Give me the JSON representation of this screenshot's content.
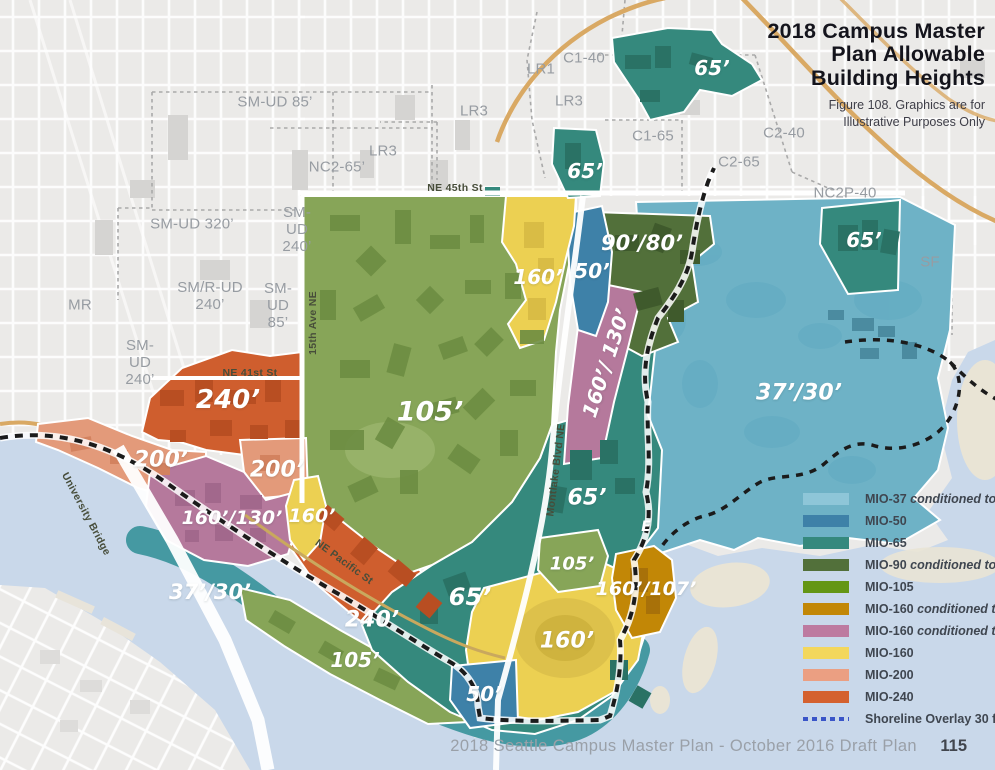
{
  "title": {
    "lines": [
      "2018 Campus Master",
      "Plan Allowable",
      "Building Heights"
    ],
    "subtitle_lines": [
      "Figure 108. Graphics are for",
      "Illustrative Purposes Only"
    ]
  },
  "footer": {
    "caption": "2018 Seattle Campus Master Plan - October 2016 Draft Plan",
    "page": "115"
  },
  "legend": {
    "items": [
      {
        "label": "MIO-37",
        "condition": "conditioned to 30",
        "color": "#8ec6d8"
      },
      {
        "label": "MIO-50",
        "condition": "",
        "color": "#3e81a8"
      },
      {
        "label": "MIO-65",
        "condition": "",
        "color": "#35897d"
      },
      {
        "label": "MIO-90",
        "condition": "conditioned to 80",
        "color": "#52703a"
      },
      {
        "label": "MIO-105",
        "condition": "",
        "color": "#649614"
      },
      {
        "label": "MIO-160",
        "condition": "conditioned to 107",
        "color": "#c28706"
      },
      {
        "label": "MIO-160",
        "condition": "conditioned to 130",
        "color": "#bd7aa0"
      },
      {
        "label": "MIO-160",
        "condition": "",
        "color": "#f3d75c"
      },
      {
        "label": "MIO-200",
        "condition": "",
        "color": "#eb9f82"
      },
      {
        "label": "MIO-240",
        "condition": "",
        "color": "#d4612f"
      }
    ],
    "shoreline": {
      "label": "Shoreline Overlay 30 ft",
      "color": "#3a55c8"
    }
  },
  "map": {
    "height_labels": [
      {
        "text": "65’",
        "x": 712,
        "y": 68,
        "size": 20
      },
      {
        "text": "65’",
        "x": 585,
        "y": 171,
        "size": 20
      },
      {
        "text": "90’/80’",
        "x": 642,
        "y": 243,
        "size": 21
      },
      {
        "text": "160’",
        "x": 538,
        "y": 277,
        "size": 20
      },
      {
        "text": "50’",
        "x": 592,
        "y": 271,
        "size": 20
      },
      {
        "text": "65’",
        "x": 864,
        "y": 240,
        "size": 20
      },
      {
        "text": "160’/ 130’",
        "x": 606,
        "y": 363,
        "size": 20,
        "rotate": -72
      },
      {
        "text": "37’/30’",
        "x": 799,
        "y": 393,
        "size": 22
      },
      {
        "text": "105’",
        "x": 430,
        "y": 412,
        "size": 27
      },
      {
        "text": "240’",
        "x": 228,
        "y": 400,
        "size": 26
      },
      {
        "text": "200’",
        "x": 161,
        "y": 460,
        "size": 22
      },
      {
        "text": "200’",
        "x": 277,
        "y": 470,
        "size": 22
      },
      {
        "text": "160’/130’",
        "x": 232,
        "y": 518,
        "size": 19
      },
      {
        "text": "160’",
        "x": 312,
        "y": 516,
        "size": 19
      },
      {
        "text": "37’/30’",
        "x": 210,
        "y": 592,
        "size": 21
      },
      {
        "text": "65’",
        "x": 470,
        "y": 597,
        "size": 24
      },
      {
        "text": "240’",
        "x": 372,
        "y": 620,
        "size": 22
      },
      {
        "text": "105’",
        "x": 355,
        "y": 660,
        "size": 20
      },
      {
        "text": "65’",
        "x": 587,
        "y": 498,
        "size": 22
      },
      {
        "text": "105’",
        "x": 572,
        "y": 564,
        "size": 18
      },
      {
        "text": "160’/107’",
        "x": 646,
        "y": 589,
        "size": 19
      },
      {
        "text": "160’",
        "x": 567,
        "y": 641,
        "size": 22
      },
      {
        "text": "50’",
        "x": 484,
        "y": 694,
        "size": 20
      },
      {
        "text": "E",
        "x": 646,
        "y": 527,
        "size": 14
      }
    ],
    "zoning_labels": [
      {
        "text": "SM-UD 85’",
        "x": 275,
        "y": 103
      },
      {
        "text": "LR3",
        "x": 383,
        "y": 152
      },
      {
        "text": "LR3",
        "x": 474,
        "y": 112
      },
      {
        "text": "NC2-65’",
        "x": 337,
        "y": 168
      },
      {
        "text": "SM-UD 320’",
        "x": 192,
        "y": 225
      },
      {
        "text": "SM-\nUD\n240’",
        "x": 297,
        "y": 230
      },
      {
        "text": "MR",
        "x": 80,
        "y": 306
      },
      {
        "text": "SM/R-UD\n240’",
        "x": 210,
        "y": 297
      },
      {
        "text": "SM-\nUD\n85’",
        "x": 278,
        "y": 306
      },
      {
        "text": "SM-\nUD\n240’",
        "x": 140,
        "y": 363
      },
      {
        "text": "LR1",
        "x": 541,
        "y": 70
      },
      {
        "text": "C1-40",
        "x": 584,
        "y": 59
      },
      {
        "text": "LR3",
        "x": 569,
        "y": 102
      },
      {
        "text": "C1-65",
        "x": 653,
        "y": 137
      },
      {
        "text": "C2-65",
        "x": 739,
        "y": 163
      },
      {
        "text": "C2-40",
        "x": 784,
        "y": 134
      },
      {
        "text": "NC2P-40",
        "x": 845,
        "y": 194
      },
      {
        "text": "SF",
        "x": 930,
        "y": 263
      }
    ],
    "street_labels": [
      {
        "text": "NE 45th St",
        "x": 455,
        "y": 188,
        "rotate": 0
      },
      {
        "text": "NE 41st St",
        "x": 250,
        "y": 373,
        "rotate": 0
      },
      {
        "text": "15th Ave NE",
        "x": 313,
        "y": 323,
        "rotate": -90
      },
      {
        "text": "Montlake Blvd NE",
        "x": 556,
        "y": 470,
        "rotate": -83
      },
      {
        "text": "NE Pacific St",
        "x": 344,
        "y": 562,
        "rotate": 36
      },
      {
        "text": "University Bridge",
        "x": 86,
        "y": 514,
        "rotate": 62
      }
    ]
  },
  "colors": {
    "land": "#ebeae8",
    "water": "#c9d8ea",
    "campus_green": "#87a558",
    "teal_65": "#35897d",
    "blue_50": "#3e81a8",
    "light_blue_37": "#6eb2c6",
    "dark_green_90": "#52703a",
    "yellow_160": "#ecd052",
    "gold_107": "#c28706",
    "pink_130": "#b5799c",
    "salmon_200": "#e39a7a",
    "orange_240": "#cf5e2e",
    "highway_tan": "#d9a964",
    "shoreline_line": "#1b1b1b"
  }
}
